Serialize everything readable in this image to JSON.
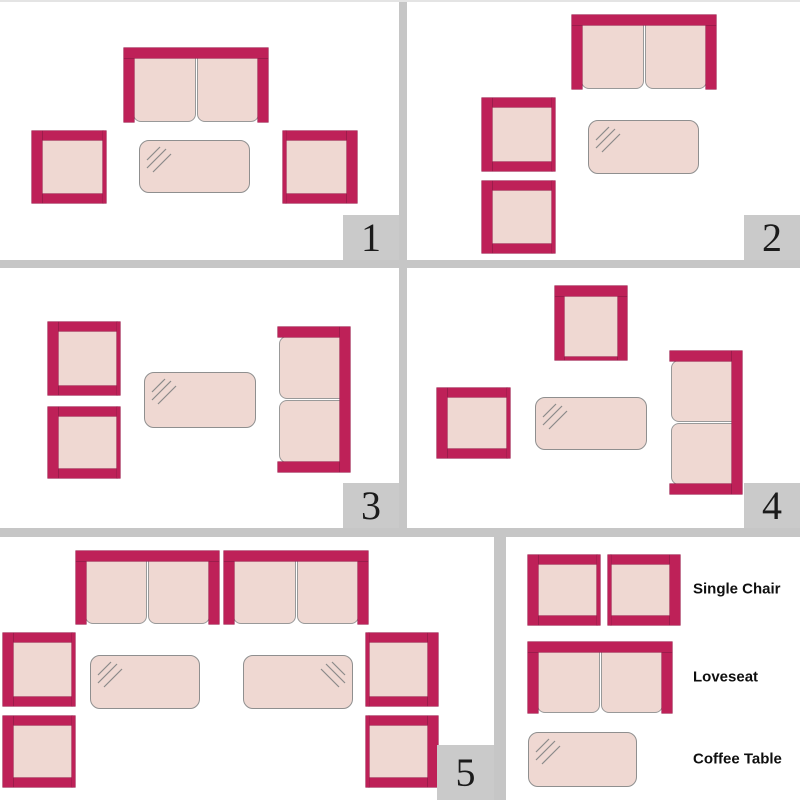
{
  "colors": {
    "frame_pink": "#BE2158",
    "frame_pink_edge": "#9C1C4B",
    "cushion_fill": "#EFD8D2",
    "cushion_border": "#999999",
    "glass_line": "#8A8A8A",
    "separator_gray": "#C6C6C6",
    "badge_gray": "#CACACA",
    "badge_text": "#1B1B1B",
    "label_text": "#0F0F0F",
    "panel_bg": "#FFFFFF"
  },
  "panels": [
    {
      "number": "1",
      "items": [
        {
          "type": "loveseat",
          "back": "top",
          "x": 124,
          "y": 48,
          "w": 144,
          "h": 74
        },
        {
          "type": "chair",
          "back": "left",
          "x": 32,
          "y": 131,
          "w": 74,
          "h": 72
        },
        {
          "type": "coffee-table",
          "reflection": "left",
          "x": 139,
          "y": 140,
          "w": 111,
          "h": 53
        },
        {
          "type": "chair",
          "back": "right",
          "x": 283,
          "y": 131,
          "w": 74,
          "h": 72
        }
      ]
    },
    {
      "number": "2",
      "items": [
        {
          "type": "loveseat",
          "back": "top",
          "x": 165,
          "y": 15,
          "w": 144,
          "h": 74
        },
        {
          "type": "chair",
          "back": "left",
          "x": 75,
          "y": 98,
          "w": 73,
          "h": 73
        },
        {
          "type": "coffee-table",
          "reflection": "left",
          "x": 181,
          "y": 120,
          "w": 111,
          "h": 54
        },
        {
          "type": "chair",
          "back": "left",
          "x": 75,
          "y": 181,
          "w": 73,
          "h": 72
        }
      ]
    },
    {
      "number": "3",
      "items": [
        {
          "type": "chair",
          "back": "left",
          "x": 48,
          "y": 54,
          "w": 72,
          "h": 73
        },
        {
          "type": "chair",
          "back": "left",
          "x": 48,
          "y": 139,
          "w": 72,
          "h": 71
        },
        {
          "type": "coffee-table",
          "reflection": "left",
          "x": 144,
          "y": 104,
          "w": 112,
          "h": 56
        },
        {
          "type": "loveseat",
          "back": "right",
          "x": 278,
          "y": 59,
          "w": 72,
          "h": 145
        }
      ]
    },
    {
      "number": "4",
      "items": [
        {
          "type": "chair",
          "back": "top",
          "x": 148,
          "y": 18,
          "w": 72,
          "h": 74
        },
        {
          "type": "chair",
          "back": "left",
          "x": 30,
          "y": 120,
          "w": 73,
          "h": 70
        },
        {
          "type": "coffee-table",
          "reflection": "left",
          "x": 128,
          "y": 129,
          "w": 112,
          "h": 53
        },
        {
          "type": "loveseat",
          "back": "right",
          "x": 263,
          "y": 83,
          "w": 72,
          "h": 143
        }
      ]
    },
    {
      "number": "5",
      "items": [
        {
          "type": "loveseat",
          "back": "top",
          "x": 76,
          "y": 14,
          "w": 143,
          "h": 73
        },
        {
          "type": "loveseat",
          "back": "top",
          "x": 224,
          "y": 14,
          "w": 144,
          "h": 73
        },
        {
          "type": "chair",
          "back": "left",
          "x": 3,
          "y": 96,
          "w": 72,
          "h": 73
        },
        {
          "type": "chair",
          "back": "left",
          "x": 3,
          "y": 179,
          "w": 72,
          "h": 71
        },
        {
          "type": "chair",
          "back": "right",
          "x": 366,
          "y": 96,
          "w": 72,
          "h": 73
        },
        {
          "type": "chair",
          "back": "right",
          "x": 366,
          "y": 179,
          "w": 72,
          "h": 71
        },
        {
          "type": "coffee-table",
          "reflection": "left",
          "x": 90,
          "y": 118,
          "w": 110,
          "h": 54
        },
        {
          "type": "coffee-table",
          "reflection": "right",
          "x": 243,
          "y": 118,
          "w": 110,
          "h": 54
        }
      ]
    }
  ],
  "legend": {
    "items": [
      {
        "type": "chair",
        "back": "left",
        "x": 22,
        "y": 18,
        "w": 72,
        "h": 70
      },
      {
        "type": "chair",
        "back": "right",
        "x": 102,
        "y": 18,
        "w": 72,
        "h": 70
      },
      {
        "type": "loveseat",
        "back": "top",
        "x": 22,
        "y": 105,
        "w": 144,
        "h": 71
      },
      {
        "type": "coffee-table",
        "reflection": "left",
        "x": 22,
        "y": 195,
        "w": 109,
        "h": 55
      }
    ],
    "entries": [
      {
        "label": "Single Chair"
      },
      {
        "label": "Loveseat"
      },
      {
        "label": "Coffee Table"
      }
    ]
  }
}
